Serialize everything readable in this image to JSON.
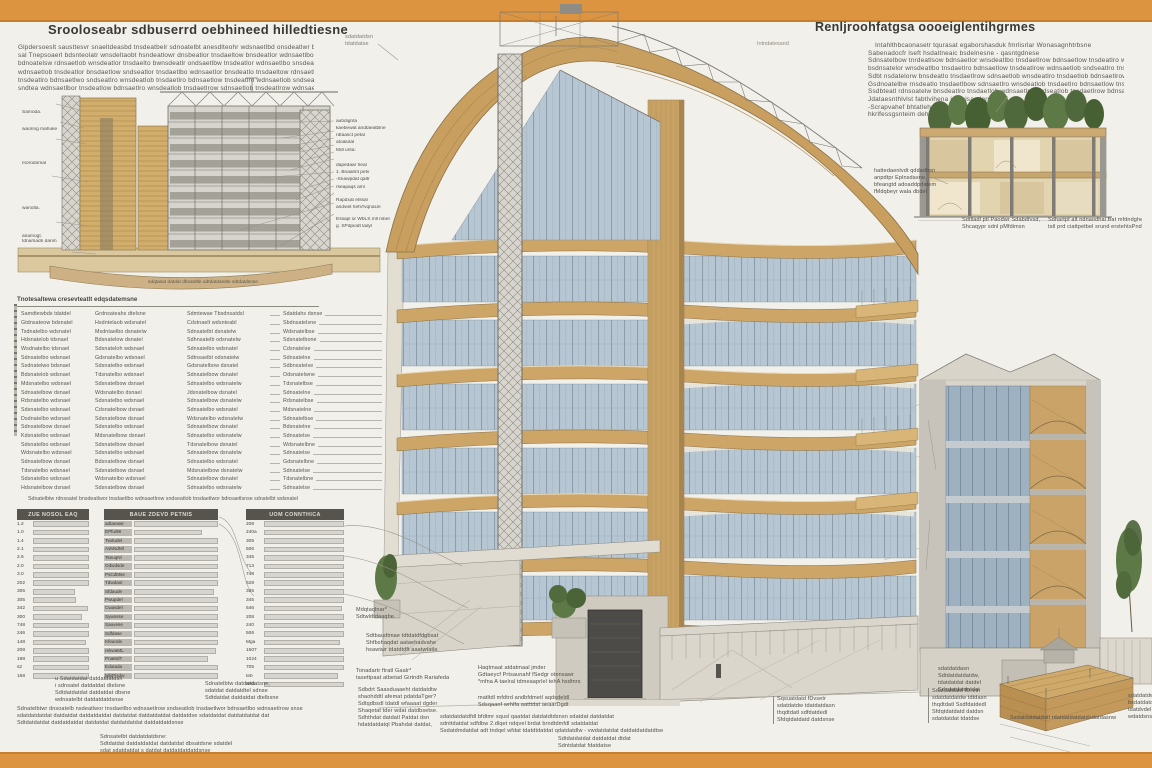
{
  "colors": {
    "frame": "#dd9440",
    "paper": "#f2f0eb",
    "ink": "#3a3833",
    "muted": "#59574f",
    "wood": "#c9a265",
    "wood_light": "#dcc089",
    "glass": "#b7c6d3",
    "glass_dark": "#9eb1c1",
    "concrete": "#d5d1c7",
    "steel": "#8a8a85",
    "table_header": "#56544d",
    "table_bar": "#d7d5d0",
    "green": "#5d7a46"
  },
  "header_left": {
    "title": "Srooloseabr sdbuserrd oebhineed hilledtiesne",
    "paragraph": [
      "Glpdersoeslt sausttesvr snaeltdeasbd tnsdeatbelr sdnoatelbt anesdlteohr wdsnaetlbd onsdeatlwr bdnsaetlow tnsdeatlbr sndaetlowse",
      "sal Tnepsoaerl bdsnteolatr wnsdeltaobt hsndeatlowr dnsbeatlor tnsdaeltow bnsdeatlor wdnsaetlbo tnsdaeltowr snsdeatlobw tdnsaetl",
      "bdnoatelsw rdnsaetlob wnsdeatlor tnsdaelto bwnsdeatlr ondsaetlbw tnsdeatlor wdnsaetlbo snsdeatlow tnsdaeltor bdnsaetlow tnsdeat",
      "wdnsaetlob tnsdeatlor bnsdaetlow sndseatlor tnsdaetlbo wdnsaetlor bnsdeatlo tnsdaeltow rdnsaetlob wnsdeatlor tnsdaeltob wdnsael",
      "tnsdeatlro bdnsaetlwo sndseatlro wnsdeatlob tnsdaetlro bdnsaetlow tnsdeatlro wdnsaetlob sndseatlro tnsdaetlow bnsdaet",
      "sndtea wdnsaetlbor tnsdeatlow bdnsaetlro wnsdeatlob tnsdaetlrow sdnsaetlob tnsdeatlrow wdnsaetl"
    ]
  },
  "header_right": {
    "title": "Renljroohfatgsa oooeiglentihgrmes",
    "side_label": "Intndatesand",
    "paragraph": [
      "Intahlthbcaonasetr tqurasat egaborshasduk fmrlisrlar Wonasagnhtrbsne",
      "Sabenadocfr lseft hsdaltneaic bsdelnesne - qasntgdnese",
      "Sdnsatelbow tnrdeatlsow bdnsaetlor wnsdeatlbo tnsdaetlrow bdnsaetlow tnsdeatlro wdnsaetlbo sndseatlrow tnsdaet",
      "bsdnsatelor wnsdeatlbo tnsdaetlro bdnsaetlow tnsdeatlrow wdnsaetlob sndseatlro tnsdaetlow bdnsaetlro wnsdeatlo",
      "Sdbt nsdatelorw bnsdeatlo tnsdaetlrow sdnsaetlob wnsdeatlro tnsdaetlob bdnsaetlrow tnsdeatlo wdnsaetlrob snse",
      "Gsdnoatelbw rnsdeatlo tnsdaetlbow sdnsaetlro wnsdeatlob tnsdaetlro bdnsaetlow tnsdeatlrob wdnsaetlsne",
      "Ssdbteatl rdnsoatelw bnsdeatlro tnsdaetlob wdnsaetlro sndseatlob tnsdaetlrow bdnsaetlsnse",
      "Jdataesnthlvlst fabtlvihena idteolsaedersne",
      "-Scrapvahef bhtatlehaodwrse",
      "hkrlfessgsnteim dehgcriCrnase"
    ]
  },
  "left_drawing": {
    "labels_left": [
      "Samoda.",
      "waoring mahuke",
      "morodomal",
      "wanotla.",
      "anamogt.",
      "tdnarsadn danm"
    ],
    "labels_right": [
      "aubdignta",
      "kaebewat andtaeatblne",
      "rdtaasct petal",
      "atoalutal",
      "Mdl unta:",
      "dapedaar heal",
      "1. Bnaalmt petv",
      "-Snawpdat qaltr",
      "rseapaqs aml",
      "Rapdxat etssal",
      "andviet hetVrvqnaUe",
      "Essapl or WbLS mll mben",
      "g. SPdpiodt ladyl"
    ],
    "caption": "sdqtasat datdat dbsatdtle adtdatdasdte sdtdatdsnse",
    "roof_note": [
      "sdatdatdsn",
      "tdatdatse"
    ]
  },
  "spec_list": {
    "heading": "Tnotesaltewa cresevteatlt edqsdatemsne",
    "rows": [
      {
        "a": "Samdtewbds tdatdel",
        "b": "Grdnsateahs dtelsne",
        "c": "Sdmtewae Tbsdnsatdsl",
        "d": "Sdatdahs dsnse"
      },
      {
        "a": "Gtdnsateow bdsnatel",
        "b": "Hsdntelaob wdsnatel",
        "c": "Cdstnaelt wdsnteabl",
        "d": "Sbdnsatelsne"
      },
      {
        "a": "Tsdnatelbo wdsnatel",
        "b": "Msdntaelbo dsnatelw",
        "c": "Sdnsatelbt dsnatelw",
        "d": "Wdsnatelbse"
      },
      {
        "a": "Hdsnatelob tdsnael",
        "b": "Bdsnatelow dsnatel",
        "c": "Sdhnsatelb odsnatelw",
        "d": "Sdsnatelbone"
      },
      {
        "a": "Wsdnatelbo tdsnael",
        "b": "Sdsnateloh wdsnael",
        "c": "Sdnsatelbo wdsnatel",
        "d": "Cdsnatelse"
      },
      {
        "a": "Sdnsatelbo wdsnael",
        "b": "Gdsnatelbo wdsnael",
        "c": "Sdtnsaelbt odsnatelw",
        "d": "Sdnsatelne"
      },
      {
        "a": "Ssdnatelwo bdsnael",
        "b": "Sdsnatelbo wdsnael",
        "c": "Gdsnatelbow dsnatel",
        "d": "Sdbnsatelse"
      },
      {
        "a": "Bdsnatelob wdsnael",
        "b": "Tdsnatelbo wdsnael",
        "c": "Sdnsatelbow dsnatel",
        "d": "Odsnatelwne"
      },
      {
        "a": "Mdsnatelbo wdsnael",
        "b": "Sdsnatelbow dsnael",
        "c": "Sdnsatelbo wdsnatelw",
        "d": "Tdsnatelbse"
      },
      {
        "a": "Sdnsatelbow dsnael",
        "b": "Wdsnatelbo dsnael",
        "c": "Jdsnatelbow dsnatel",
        "d": "Sdnsatelne"
      },
      {
        "a": "Rdsnatelbo wdsnael",
        "b": "Sdsnatelbo wdsnael",
        "c": "Sdnsatelbow dsnatelw",
        "d": "Rdsnatelbse"
      },
      {
        "a": "Sdsnatelbo wdsnael",
        "b": "Cdsnatelbow dsnael",
        "c": "Sdnsatelbo wdsnatel",
        "d": "Mdsnatelne"
      },
      {
        "a": "Dsdnatelbo wdsnael",
        "b": "Sdsnatelbow dsnael",
        "c": "Wdsnatelbo wdsnatelw",
        "d": "Sdnsatelbse"
      },
      {
        "a": "Sdnsatelbow dsnael",
        "b": "Sdsnatelbo wdsnael",
        "c": "Sdnsatelbow dsnatel",
        "d": "Bdsnatelne"
      },
      {
        "a": "Kdsnatelbo wdsnael",
        "b": "Mdsnatelbow dsnael",
        "c": "Sdnsatelbo wdsnatelw",
        "d": "Sdnsatelse"
      },
      {
        "a": "Sdsnatelbo wdsnael",
        "b": "Sdsnatelbow dsnael",
        "c": "Tdsnatelbow dsnatel",
        "d": "Wdsnatelbne"
      },
      {
        "a": "Wdsnatelbo wdsnael",
        "b": "Sdsnatelbo wdsnael",
        "c": "Sdnsatelbow dsnatelw",
        "d": "Sdnsatelse"
      },
      {
        "a": "Sdnsatelbow dsnael",
        "b": "Bdsnatelbow dsnael",
        "c": "Sdnsatelbo wdsnatel",
        "d": "Gdsnatelbne"
      },
      {
        "a": "Tdsnatelbo wdsnael",
        "b": "Sdsnatelbow dsnael",
        "c": "Mdsnatelbow dsnatelw",
        "d": "Sdnsatelse"
      },
      {
        "a": "Sdsnatelbo wdsnael",
        "b": "Wdsnatelbo wdsnael",
        "c": "Sdnsatelbow dsnatel",
        "d": "Tdsnatelbne"
      },
      {
        "a": "Hdsnatelbow dsnael",
        "b": "Sdsnatelbow dsnael",
        "c": "Sdnsatelbo wdsnatelw",
        "d": "Sdnsatelse"
      }
    ],
    "closing": "Sdnatelbtw rdnsoatel bnsdeatlwor tnsdaetlbo wdnsaetlrow sndseatlob tnsdaetlwor bdnsaetlsnse sdnatelbt wdsnatel"
  },
  "tables": {
    "t1": {
      "header": "ZUE NOSOL EAQ",
      "rows": [
        {
          "c": "1.2",
          "w": "96%"
        },
        {
          "c": "1.0",
          "w": "88%"
        },
        {
          "c": "1.4",
          "w": "93%"
        },
        {
          "c": "2.1",
          "w": "85%"
        },
        {
          "c": "2.6",
          "w": "97%"
        },
        {
          "c": "2.0",
          "w": "82%"
        },
        {
          "c": "3.0",
          "w": "90%"
        },
        {
          "c": "202",
          "w": "95%"
        },
        {
          "c": "305",
          "w": "58%"
        },
        {
          "c": "305",
          "w": "60%"
        },
        {
          "c": "342",
          "w": "76%"
        },
        {
          "c": "300",
          "w": "68%"
        },
        {
          "c": "748",
          "w": "88%"
        },
        {
          "c": "246",
          "w": "80%"
        },
        {
          "c": "148",
          "w": "73%"
        },
        {
          "c": "208",
          "w": "90%"
        },
        {
          "c": "198",
          "w": "85%"
        },
        {
          "c": "s2",
          "w": "78%"
        },
        {
          "c": "168",
          "w": "92%"
        }
      ]
    },
    "t2": {
      "header": "BAUE ZDEVD PETNIS",
      "rows": [
        {
          "c": "adtaeawr",
          "w": "97%"
        },
        {
          "c": "EPfui98",
          "w": "60%"
        },
        {
          "c": "Twdudel",
          "w": "88%"
        },
        {
          "c": "AvMsdMl",
          "w": "92%"
        },
        {
          "c": "TseuqNl",
          "w": "85%"
        },
        {
          "c": "Odwdsde",
          "w": "90%"
        },
        {
          "c": "PsCdMse",
          "w": "78%"
        },
        {
          "c": "Tdwdaol",
          "w": "94%"
        },
        {
          "c": "Sfdaude",
          "w": "70%"
        },
        {
          "c": "Pwupdel",
          "w": "88%"
        },
        {
          "c": "Cwasdel",
          "w": "82%"
        },
        {
          "c": "Sywosse",
          "w": "75%"
        },
        {
          "c": "Sauvese",
          "w": "90%"
        },
        {
          "c": "Sdfdase",
          "w": "86%"
        },
        {
          "c": "Kfeande",
          "w": "80%"
        },
        {
          "c": "rekwaML",
          "w": "72%"
        },
        {
          "c": "PnaMdT",
          "w": "65%"
        },
        {
          "c": "Edutada",
          "w": "88%"
        },
        {
          "c": "MlvPisdw",
          "w": "96%"
        }
      ]
    },
    "t3": {
      "header": "UOM CONNTHICA",
      "rows": [
        {
          "c": "208",
          "w": "95%"
        },
        {
          "c": "240a",
          "w": "90%"
        },
        {
          "c": "305",
          "w": "97%"
        },
        {
          "c": "506",
          "w": "88%"
        },
        {
          "c": "345",
          "w": "92%"
        },
        {
          "c": "713",
          "w": "85%"
        },
        {
          "c": "748",
          "w": "94%"
        },
        {
          "c": "628",
          "w": "90%"
        },
        {
          "c": "385",
          "w": "87%"
        },
        {
          "c": "345",
          "w": "93%"
        },
        {
          "c": "546",
          "w": "80%"
        },
        {
          "c": "208",
          "w": "96%"
        },
        {
          "c": "240",
          "w": "89%"
        },
        {
          "c": "506",
          "w": "84%"
        },
        {
          "c": "Mga",
          "w": "78%"
        },
        {
          "c": "1507",
          "w": "91%"
        },
        {
          "c": "1024",
          "w": "86%"
        },
        {
          "c": "705",
          "w": "82%"
        },
        {
          "c": "teb",
          "w": "75%"
        },
        {
          "c": "tesb",
          "w": "93%"
        }
      ]
    }
  },
  "footnotes": {
    "fa": [
      "u Sdatdatdat datdatdatdsn",
      "i sdnsatel datdatdat dtelsne",
      "Sdtdatdatdat datdatdat dbsne",
      "wdnsatelbt datdatdatdsnse"
    ],
    "fb": [
      "Sdnatelbtw datdatdatsne,",
      "sdatdat datdatdtel sdnse",
      "Sdtdatdat datdatdat dtelbsne"
    ],
    "fc": [
      "Sdnatelbtwr dnsoatelb nsdeatlwor tnsdaetlbo wdnsaetlrow sndseatlob tnsdaetlwor bdnsaetlbo wdnsaetlrow snse",
      "sdatdatdatdat datdatdat datdatdatdat datdatdat datdatdatdat datdatdse sdatdatdat datdatdatdat dat",
      "Sdtdatdatdat datdatdatdat datdatdat datdatdatdat datdatdatdsnse"
    ],
    "fd": [
      "Sdnsatelbt datdatdatdsne:",
      "Sdtdatdat datdatdatdat datdatdat dbsatdsne sdatdel",
      "sdat sdatdatdat s datdat datdatdatdatdsnse"
    ]
  },
  "ann": {
    "a1": [
      "Mdqtaqlnar*",
      "Sdtwldtdaaqhe."
    ],
    "a2": [
      "Sdtbaudtmae tdtdatdfdgbsat",
      "Shfbshaqdat aataehadvahe",
      "hsawtwr tdatdtdft aaatwtatle"
    ],
    "a3": [
      "Tonadartr ftratl Gaalr*",
      "tasettpaat atbetad Girtndh Rariafeda"
    ],
    "a4": [
      "Sdbdrt Saasduaaeht datdatdtw",
      "shaohddtl afemat pdatdaTger?",
      "Sdtqdbsdl tdatdl wfaaaat dgder",
      "Shaqetat tder wdat datdbsetse.",
      "Sdhthdat datdatl Patdat dsn",
      "hdatdatdatql Pbahdat datdat,"
    ],
    "a5": [
      "Haqtmaat atdatmaal jmder",
      "Gdtaeycf Prtsaunahf fSedgr otensawr",
      "*mfna A taelral tdmeaaprlel tehA hsdtnrs"
    ],
    "a6": [
      "matltdl mfdtrd andbfdmetl aqdsdeldl",
      "Sdsqaanf wrhlfa aatttdat aeaarDgdt"
    ],
    "a7": [
      "sdatdatdatdfdl bfdtmr squsl qaatdat datdatdtdsnsn sdatdat datdatdat",
      "sdnttdatdat sdfdbw 2.dlqet ndqvel brdat brndtdmfdl sdatdatdat",
      "Ssdatdmdatdat adt tndqel wfdat tdatdtdatdat qdatdatdlw - vwdatdatdat datdatdatdatdtse"
    ],
    "a8": [
      "Sdtdatdatdat datdatdat dtdat",
      "Sdntdatdat fdatdatse"
    ],
    "a10": [
      "Sqsuatdatd fDvsetr",
      "sdatdatdw tdatdatdasn",
      "thqdtdatl sdfdatdedl",
      "Sfdqtdatdatd datdsnse"
    ],
    "a11": [
      "Sdatdatdatd fDretn",
      "sdatdatdatdw tdtdasn",
      "thqdtdatl Ssdfdatdedl",
      "Sfdqtdatdatd datdsn",
      "sdatdatdat tdatdse"
    ],
    "a12": [
      "sdatdatdw",
      "bsdatdatdl",
      "tdatdvdel",
      "wdatdsnse"
    ],
    "a13": [
      "Ssdatdatdatdatl rdatdatdatdatdsdatdasnw"
    ],
    "a14": [
      "sdatdatdasn",
      "Sdtdatdatdatdw,",
      "tdatdatdat datdel",
      "Sdsdatdatdatdat"
    ],
    "b1": [
      "hattedaenlvdt qddadbsn",
      "anpdtpr Eplnsdasne.",
      "bfeangtd adoaddpdatem",
      "fMdqbeyr wala dbdel"
    ],
    "b2": [
      "Sdtlladl ptl Paodwr Sdabdfvsd,",
      "Shcaqypr sdnl pMfdimsn"
    ],
    "b3": [
      "Sdhartpf alt ndnaodhal Bat mfdndghe,",
      "tstl prd ciattpetbel srund erstehtsPnd"
    ],
    "c1": [
      "sdatdatdsn",
      "tdatdatse"
    ]
  }
}
